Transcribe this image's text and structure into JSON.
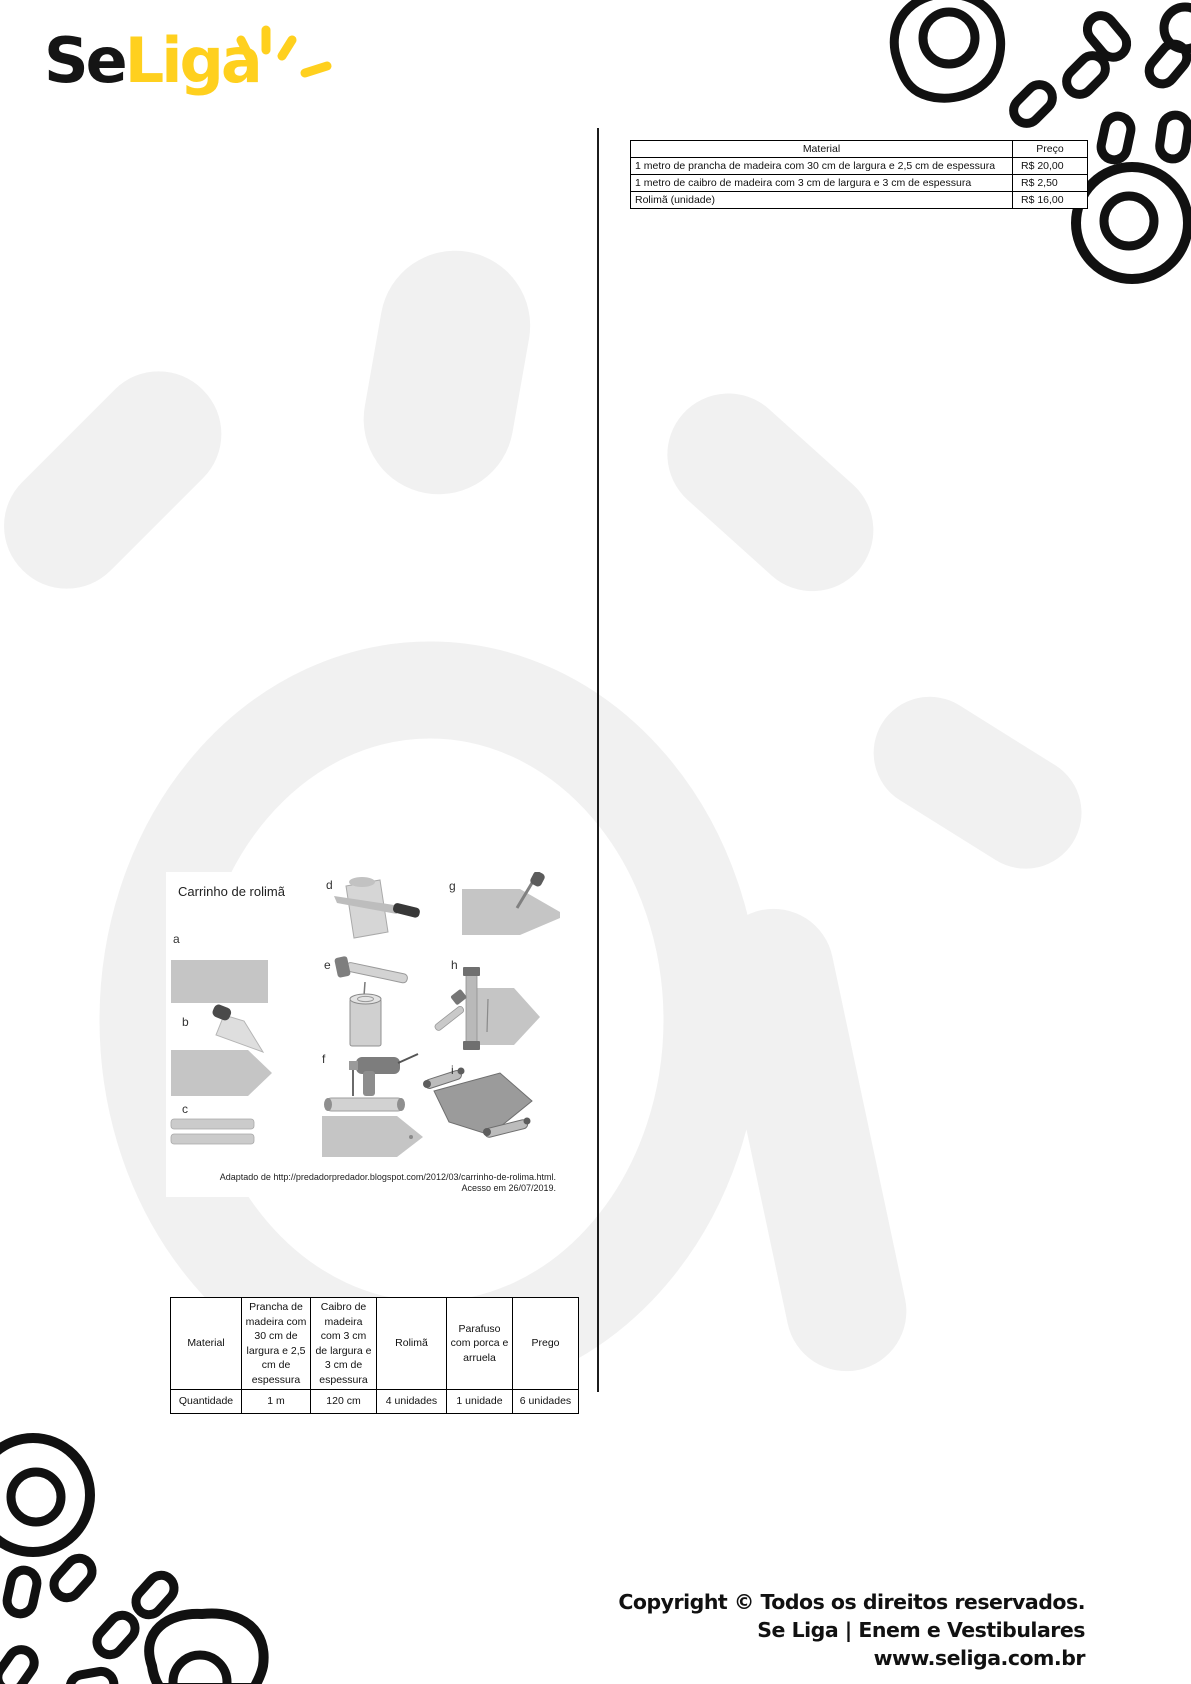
{
  "logo": {
    "text_black": "Se",
    "text_yellow": "Liga"
  },
  "price_table": {
    "header_material": "Material",
    "header_price": "Preço",
    "rows": [
      {
        "material": "1 metro de prancha de madeira com 30 cm  de largura e  2,5 cm de espessura",
        "price": "R$ 20,00"
      },
      {
        "material": "1 metro de caibro de madeira com  3 cm  de largura e  3 cm  de espessura",
        "price": "R$ 2,50"
      },
      {
        "material": "Rolimã (unidade)",
        "price": "R$ 16,00"
      }
    ]
  },
  "figure": {
    "title": "Carrinho de rolimã",
    "labels": [
      "a",
      "b",
      "c",
      "d",
      "e",
      "f",
      "g",
      "h",
      "i"
    ],
    "source_line1": "Adaptado de http://predadorpredador.blogspot.com/2012/03/carrinho-de-rolima.html.",
    "source_line2": "Acesso em 26/07/2019."
  },
  "materials_table": {
    "header_row_label": "Material",
    "quantity_row_label": "Quantidade",
    "columns": [
      {
        "material": "Prancha de madeira com 30 cm  de largura e 2,5 cm de espessura",
        "quantity": "1 m"
      },
      {
        "material": "Caibro de madeira com 3 cm  de largura e 3 cm de espessura",
        "quantity": "120 cm"
      },
      {
        "material": "Rolimã",
        "quantity": "4  unidades"
      },
      {
        "material": "Parafuso com porca e arruela",
        "quantity": "1 unidade"
      },
      {
        "material": "Prego",
        "quantity": "6  unidades"
      }
    ]
  },
  "footer": {
    "line1": "Copyright © Todos os direitos reservados.",
    "line2": "Se Liga | Enem e Vestibulares",
    "line3": "www.seliga.com.br"
  },
  "colors": {
    "brand_yellow": "#FFD01E",
    "brand_black": "#151515",
    "illustration_gray": "#c5c5c5",
    "watermark_gray": "#f1f1f1",
    "doodle_black": "#111111"
  }
}
